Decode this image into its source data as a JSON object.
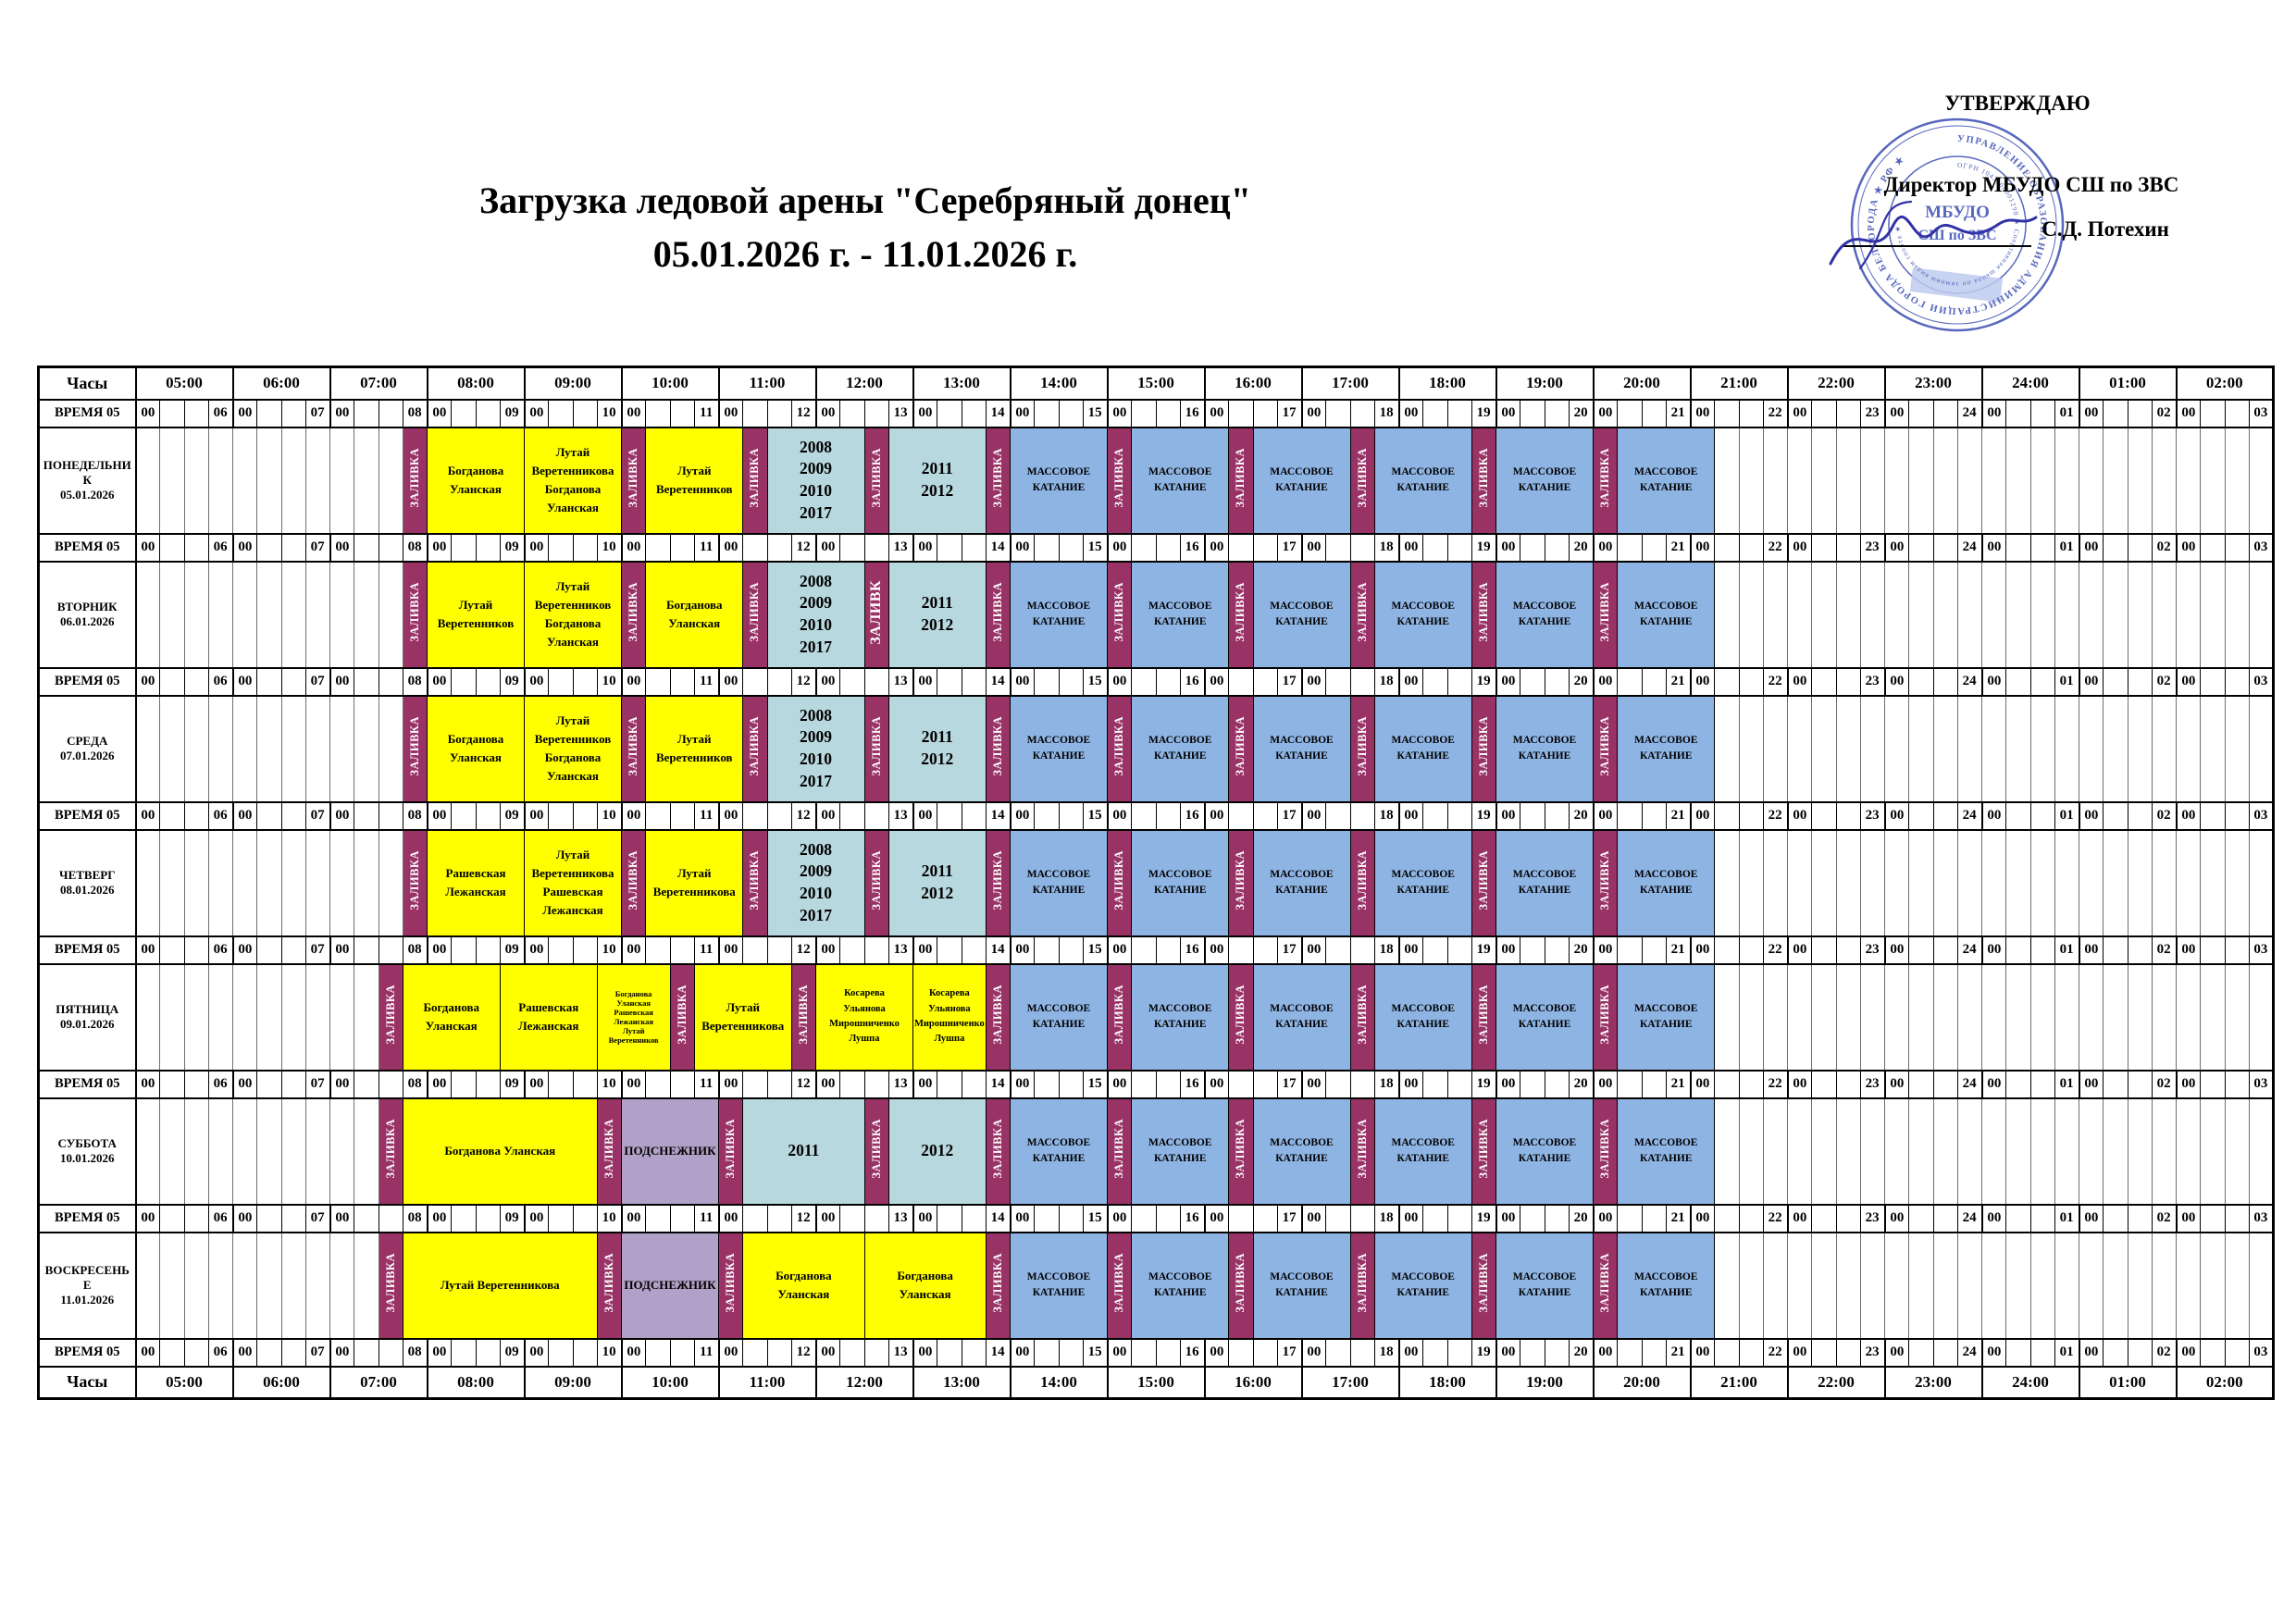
{
  "title": {
    "line1": "Загрузка ледовой арены \"Серебряный донец\"",
    "line2": "05.01.2026 г. - 11.01.2026 г."
  },
  "approval": {
    "line1": "УТВЕРЖДАЮ",
    "line2": "Директор МБУДО СШ по ЗВС",
    "line3": "С.Д. Потехин",
    "stamp": {
      "ring_outer": "УПРАВЛЕНИЕ ОБРАЗОВАНИЯ АДМИНИСТРАЦИИ ГОРОДА БЕЛГОРОДА ★ РФ ★",
      "ring_inner": "ОГРН 1043108001298 ★ Спортивная школа по зимним видам спорта ★",
      "center_line1": "МБУДО",
      "center_line2": "СШ по ЗВС"
    }
  },
  "colors": {
    "zalivka": "#993366",
    "group": "#ffff00",
    "years": "#b7d8de",
    "mass": "#8eb4e3",
    "podsneznik": "#b1a0c7",
    "stamp_blue": "#4053b5",
    "signature": "#3232a8"
  },
  "table": {
    "corner_label": "Часы",
    "time_header": "ВРЕМЯ 05",
    "time_zero": "00",
    "hours": [
      "05:00",
      "06:00",
      "07:00",
      "08:00",
      "09:00",
      "10:00",
      "11:00",
      "12:00",
      "13:00",
      "14:00",
      "15:00",
      "16:00",
      "17:00",
      "18:00",
      "19:00",
      "20:00",
      "21:00",
      "22:00",
      "23:00",
      "24:00",
      "01:00",
      "02:00"
    ],
    "time_groups": [
      "06",
      "07",
      "08",
      "09",
      "10",
      "11",
      "12",
      "13",
      "14",
      "15",
      "16",
      "17",
      "18",
      "19",
      "20",
      "21",
      "22",
      "23",
      "24",
      "01",
      "02",
      "03"
    ],
    "labels": {
      "zalivka": "ЗАЛИВКА",
      "zalivka_big": "ЗАЛИВК",
      "mass": [
        "МАССОВОЕ",
        "КАТАНИЕ"
      ],
      "podsneznik": "ПОДСНЕЖНИК"
    },
    "layout": {
      "day_col_w": 105,
      "q_col_w": 26.25,
      "quarters_total": 88
    },
    "mass_tail": [
      {
        "s": 35,
        "e": 36,
        "t": "z"
      },
      {
        "s": 36,
        "e": 40,
        "t": "m"
      },
      {
        "s": 40,
        "e": 41,
        "t": "z"
      },
      {
        "s": 41,
        "e": 45,
        "t": "m"
      },
      {
        "s": 45,
        "e": 46,
        "t": "z"
      },
      {
        "s": 46,
        "e": 50,
        "t": "m"
      },
      {
        "s": 50,
        "e": 51,
        "t": "z"
      },
      {
        "s": 51,
        "e": 55,
        "t": "m"
      },
      {
        "s": 55,
        "e": 56,
        "t": "z"
      },
      {
        "s": 56,
        "e": 60,
        "t": "m"
      },
      {
        "s": 60,
        "e": 61,
        "t": "z"
      },
      {
        "s": 61,
        "e": 65,
        "t": "m"
      }
    ],
    "days": [
      {
        "name": "ПОНЕДЕЛЬНИК",
        "date": "05.01.2026",
        "blocks": [
          {
            "s": 11,
            "e": 12,
            "t": "z"
          },
          {
            "s": 12,
            "e": 16,
            "t": "g",
            "lines": [
              "Богданова",
              "Уланская"
            ]
          },
          {
            "s": 16,
            "e": 20,
            "t": "g",
            "lines": [
              "Лутай",
              "Веретенникова",
              "Богданова",
              "Уланская"
            ]
          },
          {
            "s": 20,
            "e": 21,
            "t": "z"
          },
          {
            "s": 21,
            "e": 25,
            "t": "g",
            "lines": [
              "Лутай",
              "Веретенников"
            ]
          },
          {
            "s": 25,
            "e": 26,
            "t": "z"
          },
          {
            "s": 26,
            "e": 30,
            "t": "y",
            "lines": [
              "2008",
              "2009",
              "2010",
              "2017"
            ]
          },
          {
            "s": 30,
            "e": 31,
            "t": "z"
          },
          {
            "s": 31,
            "e": 35,
            "t": "y",
            "lines": [
              "2011",
              "2012"
            ]
          }
        ]
      },
      {
        "name": "ВТОРНИК",
        "date": "06.01.2026",
        "blocks": [
          {
            "s": 11,
            "e": 12,
            "t": "z"
          },
          {
            "s": 12,
            "e": 16,
            "t": "g",
            "lines": [
              "Лутай",
              "Веретенников"
            ]
          },
          {
            "s": 16,
            "e": 20,
            "t": "g",
            "lines": [
              "Лутай",
              "Веретенников",
              "Богданова",
              "Уланская"
            ]
          },
          {
            "s": 20,
            "e": 21,
            "t": "z"
          },
          {
            "s": 21,
            "e": 25,
            "t": "g",
            "lines": [
              "Богданова",
              "Уланская"
            ]
          },
          {
            "s": 25,
            "e": 26,
            "t": "z"
          },
          {
            "s": 26,
            "e": 30,
            "t": "y",
            "lines": [
              "2008",
              "2009",
              "2010",
              "2017"
            ]
          },
          {
            "s": 30,
            "e": 31,
            "t": "zb"
          },
          {
            "s": 31,
            "e": 35,
            "t": "y",
            "lines": [
              "2011",
              "2012"
            ]
          }
        ]
      },
      {
        "name": "СРЕДА",
        "date": "07.01.2026",
        "blocks": [
          {
            "s": 11,
            "e": 12,
            "t": "z"
          },
          {
            "s": 12,
            "e": 16,
            "t": "g",
            "lines": [
              "Богданова",
              "Уланская"
            ]
          },
          {
            "s": 16,
            "e": 20,
            "t": "g",
            "lines": [
              "Лутай",
              "Веретенников",
              "Богданова",
              "Уланская"
            ]
          },
          {
            "s": 20,
            "e": 21,
            "t": "z"
          },
          {
            "s": 21,
            "e": 25,
            "t": "g",
            "lines": [
              "Лутай",
              "Веретенников"
            ]
          },
          {
            "s": 25,
            "e": 26,
            "t": "z"
          },
          {
            "s": 26,
            "e": 30,
            "t": "y",
            "lines": [
              "2008",
              "2009",
              "2010",
              "2017"
            ]
          },
          {
            "s": 30,
            "e": 31,
            "t": "z"
          },
          {
            "s": 31,
            "e": 35,
            "t": "y",
            "lines": [
              "2011",
              "2012"
            ]
          }
        ]
      },
      {
        "name": "ЧЕТВЕРГ",
        "date": "08.01.2026",
        "blocks": [
          {
            "s": 11,
            "e": 12,
            "t": "z"
          },
          {
            "s": 12,
            "e": 16,
            "t": "g",
            "lines": [
              "Рашевская",
              "Лежанская"
            ]
          },
          {
            "s": 16,
            "e": 20,
            "t": "g",
            "lines": [
              "Лутай",
              "Веретенникова",
              "Рашевская",
              "Лежанская"
            ]
          },
          {
            "s": 20,
            "e": 21,
            "t": "z"
          },
          {
            "s": 21,
            "e": 25,
            "t": "g",
            "lines": [
              "Лутай",
              "Веретенникова"
            ]
          },
          {
            "s": 25,
            "e": 26,
            "t": "z"
          },
          {
            "s": 26,
            "e": 30,
            "t": "y",
            "lines": [
              "2008",
              "2009",
              "2010",
              "2017"
            ]
          },
          {
            "s": 30,
            "e": 31,
            "t": "z"
          },
          {
            "s": 31,
            "e": 35,
            "t": "y",
            "lines": [
              "2011",
              "2012"
            ]
          }
        ]
      },
      {
        "name": "ПЯТНИЦА",
        "date": "09.01.2026",
        "blocks": [
          {
            "s": 10,
            "e": 11,
            "t": "z"
          },
          {
            "s": 11,
            "e": 15,
            "t": "g",
            "lines": [
              "Богданова",
              "Уланская"
            ]
          },
          {
            "s": 15,
            "e": 19,
            "t": "g",
            "lines": [
              "Рашевская",
              "Лежанская"
            ]
          },
          {
            "s": 19,
            "e": 22,
            "t": "gs",
            "fs": 8.5,
            "lines": [
              "Богданова",
              "Уланская",
              "Рашевская",
              "Лежанская",
              "Лутай",
              "Веретенников"
            ]
          },
          {
            "s": 22,
            "e": 23,
            "t": "z"
          },
          {
            "s": 23,
            "e": 27,
            "t": "g",
            "lines": [
              "Лутай",
              "Веретенникова"
            ]
          },
          {
            "s": 27,
            "e": 28,
            "t": "z"
          },
          {
            "s": 28,
            "e": 32,
            "t": "g",
            "fs": 10.5,
            "lines": [
              "Косарева",
              "Ульянова",
              "Мирошниченко",
              "Лушпа"
            ]
          },
          {
            "s": 32,
            "e": 35,
            "t": "g",
            "fs": 10.5,
            "lines": [
              "Косарева",
              "Ульянова",
              "Мирошниченко",
              "Лушпа"
            ]
          }
        ]
      },
      {
        "name": "СУББОТА",
        "date": "10.01.2026",
        "blocks": [
          {
            "s": 10,
            "e": 11,
            "t": "z"
          },
          {
            "s": 11,
            "e": 19,
            "t": "g",
            "lines": [
              "Богданова Уланская"
            ]
          },
          {
            "s": 19,
            "e": 20,
            "t": "z"
          },
          {
            "s": 20,
            "e": 24,
            "t": "p"
          },
          {
            "s": 24,
            "e": 25,
            "t": "z"
          },
          {
            "s": 25,
            "e": 30,
            "t": "y",
            "lines": [
              "2011"
            ]
          },
          {
            "s": 30,
            "e": 31,
            "t": "z"
          },
          {
            "s": 31,
            "e": 35,
            "t": "y",
            "lines": [
              "2012"
            ]
          }
        ]
      },
      {
        "name": "ВОСКРЕСЕНЬЕ",
        "date": "11.01.2026",
        "blocks": [
          {
            "s": 10,
            "e": 11,
            "t": "z"
          },
          {
            "s": 11,
            "e": 19,
            "t": "g",
            "lines": [
              "Лутай Веретенникова"
            ]
          },
          {
            "s": 19,
            "e": 20,
            "t": "z"
          },
          {
            "s": 20,
            "e": 24,
            "t": "p"
          },
          {
            "s": 24,
            "e": 25,
            "t": "z"
          },
          {
            "s": 25,
            "e": 30,
            "t": "g",
            "lines": [
              "Богданова",
              "Уланская"
            ]
          },
          {
            "s": 30,
            "e": 35,
            "t": "g",
            "lines": [
              "Богданова",
              "Уланская"
            ]
          }
        ]
      }
    ]
  }
}
